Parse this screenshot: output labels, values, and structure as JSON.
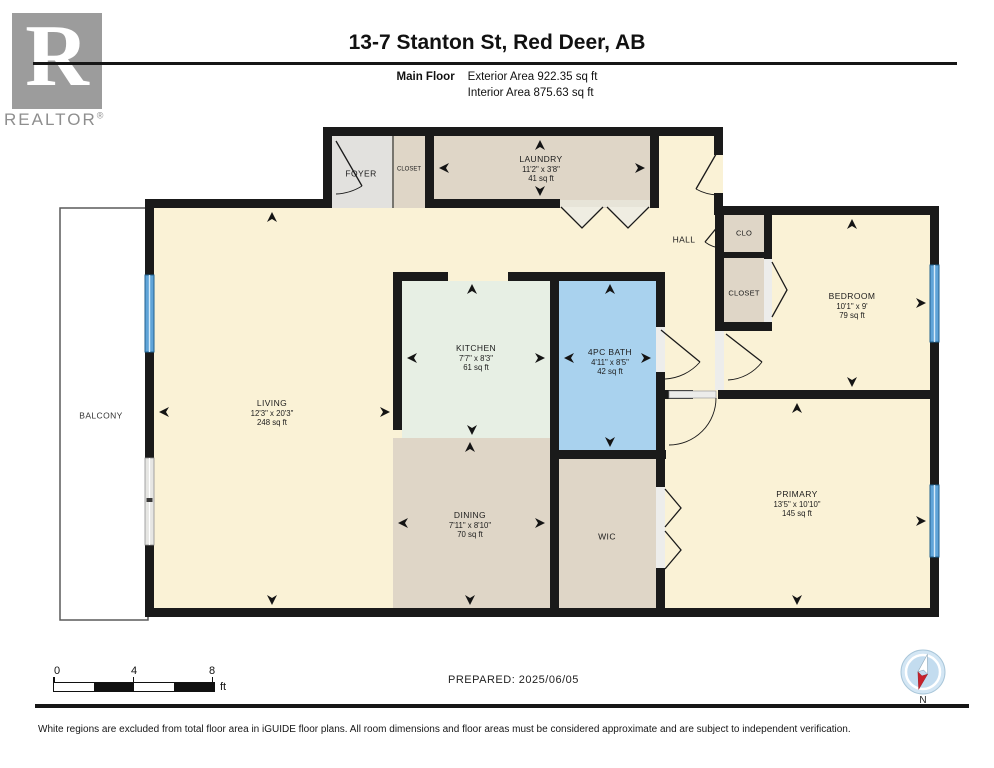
{
  "header": {
    "logo_letter": "R",
    "logo_text": "REALTOR",
    "logo_reg": "®",
    "title": "13-7 Stanton St, Red Deer, AB",
    "floor_label": "Main Floor",
    "exterior_area": "Exterior Area 922.35 sq ft",
    "interior_area": "Interior Area 875.63 sq ft"
  },
  "rooms": {
    "living": {
      "name": "LIVING",
      "dims": "12'3\" x 20'3\"",
      "area": "248 sq ft"
    },
    "kitchen": {
      "name": "KITCHEN",
      "dims": "7'7\" x 8'3\"",
      "area": "61 sq ft"
    },
    "dining": {
      "name": "DINING",
      "dims": "7'11\" x 8'10\"",
      "area": "70 sq ft"
    },
    "bath": {
      "name": "4PC BATH",
      "dims": "4'11\" x 8'5\"",
      "area": "42 sq ft"
    },
    "laundry": {
      "name": "LAUNDRY",
      "dims": "11'2\" x 3'8\"",
      "area": "41 sq ft"
    },
    "bedroom": {
      "name": "BEDROOM",
      "dims": "10'1\" x 9'",
      "area": "79 sq ft"
    },
    "primary": {
      "name": "PRIMARY",
      "dims": "13'5\" x 10'10\"",
      "area": "145 sq ft"
    },
    "wic": {
      "name": "WIC"
    },
    "hall": {
      "name": "HALL"
    },
    "foyer": {
      "name": "FOYER"
    },
    "closet_top": {
      "name": "CLOSET"
    },
    "clo": {
      "name": "CLO"
    },
    "closet_right": {
      "name": "CLOSET"
    },
    "balcony": {
      "name": "BALCONY"
    }
  },
  "palette": {
    "wall": "#1A1A1A",
    "floor_cream": "#FAF2D6",
    "floor_tan": "#DFD6C7",
    "floor_mint": "#E7EFE4",
    "floor_bath_blue": "#A9D2EE",
    "foyer_gray": "#E2E1DE",
    "window_blue": "#5FA4D8",
    "balcony_white": "#FFFFFF",
    "compass_red": "#C8202A"
  },
  "footer": {
    "scale": {
      "t0": "0",
      "t4": "4",
      "t8": "8",
      "unit": "ft"
    },
    "prepared": "PREPARED: 2025/06/05",
    "compass_n": "N",
    "disclaimer": "White regions are excluded from total floor area in iGUIDE floor plans. All room dimensions and floor areas must be considered approximate and are subject to independent verification."
  }
}
